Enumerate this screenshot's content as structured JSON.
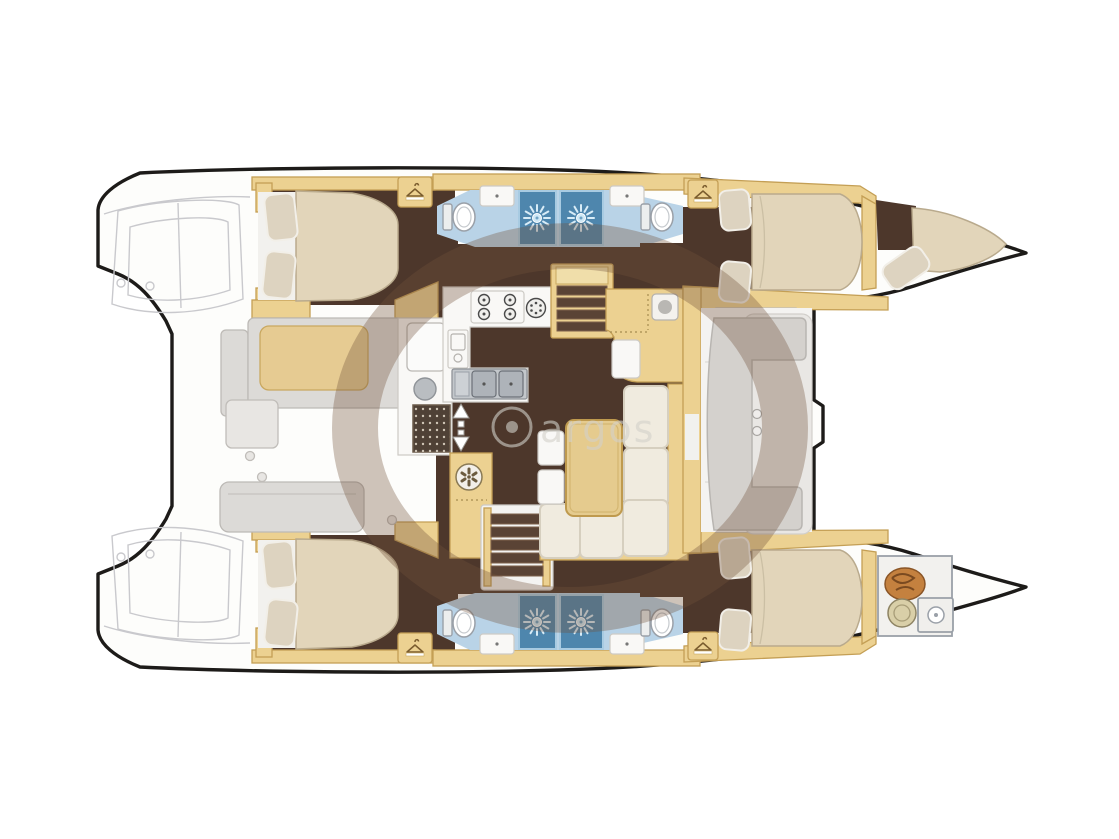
{
  "image": {
    "kind": "catamaran-yacht-floor-plan",
    "width": 1119,
    "height": 839
  },
  "watermark": {
    "text": "argos"
  },
  "palette": {
    "outline": "#1d1b19",
    "floor": "#4d372b",
    "wood": "#ecd191",
    "woodBorder": "#c49f55",
    "mattress": "#e2d5ba",
    "mattressBorder": "#b9aa8d",
    "pillow": "#ddd3c0",
    "bathFloor": "#b9d3e7",
    "shower": "#4e86ad",
    "showerBorder": "#a8cbe2",
    "bench": "#dcdad7",
    "benchBorder": "#bdbab6",
    "tanCushion": "#e6cb92",
    "tanBorder": "#c9a860",
    "cream": "#f0ebdf",
    "creamBorder": "#d6cfbf",
    "faint": "#c9c9cd",
    "anchorChain": "#c4813f",
    "watermark": "rgba(115,82,58,0.34)",
    "watermarkText": "rgba(210,208,202,0.60)"
  },
  "legend": {
    "icons": [
      "hanger-icon",
      "shower-rose-icon",
      "toilet-icon",
      "basin-icon",
      "stove-burner-icon",
      "cooktop-element-icon",
      "double-sink-icon",
      "round-sink-icon",
      "vent-fan-icon",
      "companionway-arrow-icon",
      "anchor-chain-icon",
      "drain-grate-icon"
    ],
    "areas": [
      "aft-cabin-port",
      "aft-cabin-starboard",
      "fwd-cabin-port",
      "fwd-cabin-starboard",
      "head-port-aft",
      "head-port-fwd",
      "head-starboard-aft",
      "head-starboard-fwd",
      "shower-stalls",
      "galley",
      "salon-sofa",
      "salon-table",
      "aft-cockpit",
      "forward-cockpit",
      "trampoline",
      "anchor-locker",
      "crew-berth"
    ]
  }
}
